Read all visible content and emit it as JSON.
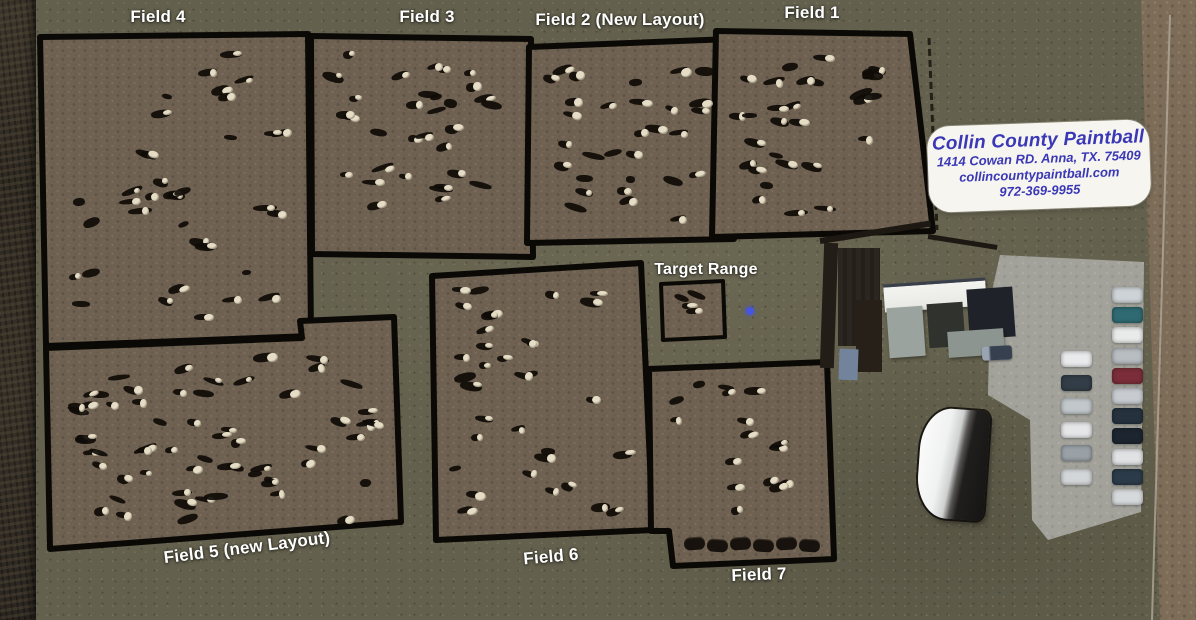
{
  "overlay_labels": {
    "field1": "Field 1",
    "field2": "Field 2 (New Layout)",
    "field3": "Field 3",
    "field4": "Field 4",
    "field5": "Field 5 (new Layout)",
    "field6": "Field 6",
    "field7": "Field 7",
    "target_range": "Target Range"
  },
  "info_card": {
    "business_name": "Collin County Paintball",
    "address": "1414 Cowan RD. Anna, TX. 75409",
    "website": "collincountypaintball.com",
    "phone": "972-369-9955"
  },
  "colors": {
    "label_text": "#ffffff",
    "card_background": "#f7f5ef",
    "card_text": "#3a38b6",
    "field_boundary": "#0b0906",
    "grass": "#63604d",
    "field_dirt": "#6e6151",
    "pavement": "#a2a29b",
    "marker_blue": "#4556e0"
  }
}
